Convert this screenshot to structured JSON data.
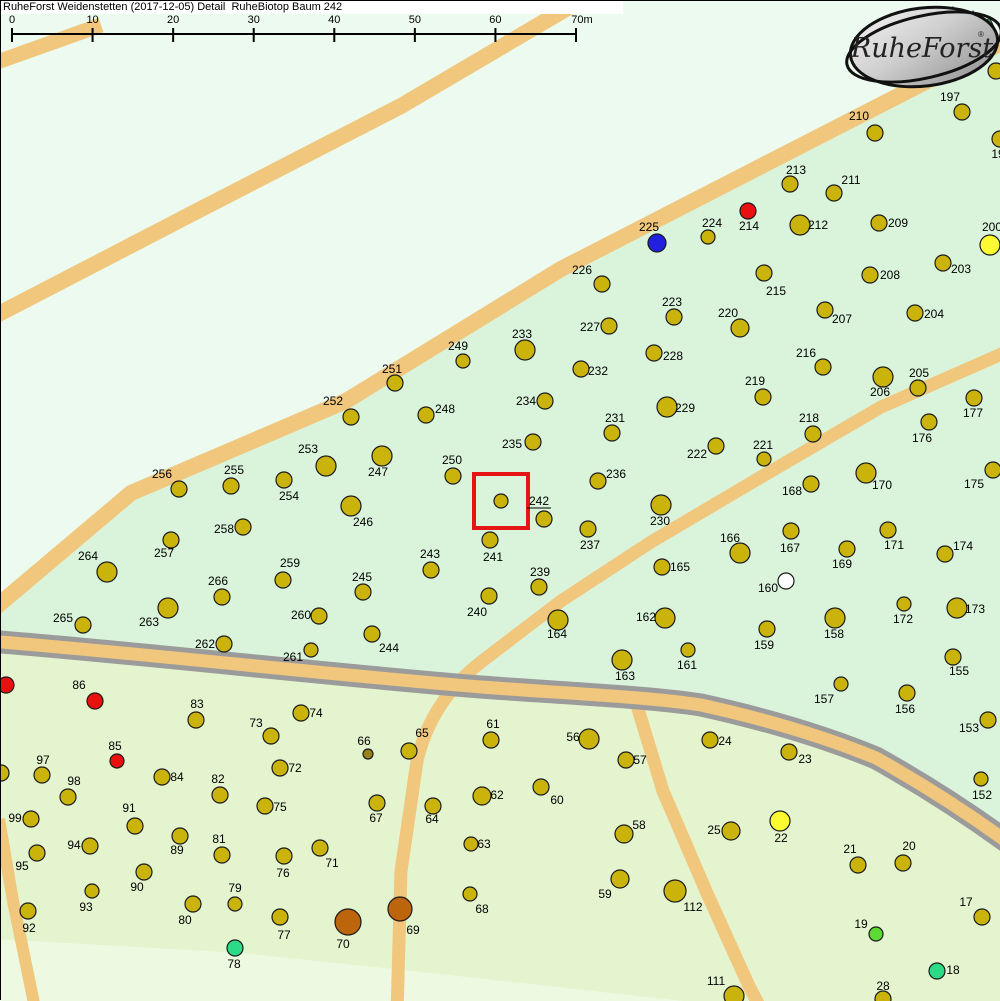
{
  "header": {
    "title": "RuheForst Weidenstetten (2017-12-05) Detail  RuheBiotop Baum 242"
  },
  "scalebar": {
    "labels": [
      "0",
      "10",
      "20",
      "30",
      "40",
      "50",
      "60",
      "70m"
    ],
    "x_start": 11,
    "x_end": 575,
    "baseline_y": 33
  },
  "logo": {
    "text": "RuheForst",
    "registered_mark": "®"
  },
  "selection": {
    "number": "242",
    "box": [
      473,
      473,
      54,
      54
    ],
    "box_color": "#e61414"
  },
  "colors": {
    "d": "#cab40c",
    "o": "#bd650c",
    "r": "#ea1010",
    "b": "#2020dd",
    "w": "#ffffff",
    "y": "#fcfa30",
    "g": "#2bdb85",
    "gy": "#5cd932",
    "dk": "#97831c",
    "dot_stroke": "#1a1a1a",
    "area_pale": "#ecfaef",
    "area_mint": "#daf4dc",
    "area_bottom": "#e4f4cf",
    "area_bottom_pale": "#eef9e2",
    "path_tan": "#f0c77c",
    "road_gray": "#9b9b9b",
    "logo_tree_green": "#2d9e4f"
  },
  "chart_data": {
    "type": "scatter",
    "title": "RuheForst Weidenstetten tree map detail around RuheBiotop Baum 242",
    "note": "trees format: [number, dotX, dotY, labelX, labelY, colorKey, radius]; empty number = dot with no visible label"
  },
  "trees": [
    [
      "197",
      961,
      111,
      949,
      96
    ],
    [
      "19",
      999,
      138,
      997,
      153
    ],
    [
      "",
      995,
      70
    ],
    [
      "210",
      874,
      132,
      858,
      115
    ],
    [
      "213",
      789,
      183,
      795,
      169
    ],
    [
      "211",
      833,
      192,
      850,
      179
    ],
    [
      "214",
      747,
      210,
      748,
      225,
      "r",
      8
    ],
    [
      "224",
      707,
      236,
      711,
      222,
      "d",
      7
    ],
    [
      "225",
      656,
      242,
      648,
      226,
      "b",
      9
    ],
    [
      "212",
      799,
      224,
      817,
      224,
      "d",
      10
    ],
    [
      "209",
      878,
      222,
      897,
      222
    ],
    [
      "200",
      989,
      244,
      991,
      226,
      "y",
      10
    ],
    [
      "226",
      601,
      283,
      581,
      269
    ],
    [
      "208",
      869,
      274,
      889,
      274
    ],
    [
      "203",
      942,
      262,
      960,
      268
    ],
    [
      "215",
      763,
      272,
      775,
      290
    ],
    [
      "223",
      673,
      316,
      671,
      301
    ],
    [
      "220",
      739,
      327,
      727,
      312,
      "d",
      9
    ],
    [
      "207",
      824,
      309,
      841,
      318
    ],
    [
      "204",
      914,
      312,
      933,
      313
    ],
    [
      "227",
      608,
      325,
      589,
      326
    ],
    [
      "216",
      822,
      366,
      805,
      352
    ],
    [
      "228",
      653,
      352,
      672,
      355
    ],
    [
      "232",
      580,
      368,
      597,
      370
    ],
    [
      "206",
      882,
      376,
      879,
      391,
      "d",
      10
    ],
    [
      "205",
      917,
      387,
      918,
      372
    ],
    [
      "177",
      973,
      397,
      972,
      412
    ],
    [
      "219",
      762,
      396,
      754,
      380
    ],
    [
      "229",
      666,
      406,
      684,
      407,
      "d",
      10
    ],
    [
      "231",
      611,
      432,
      614,
      417
    ],
    [
      "218",
      812,
      433,
      808,
      417
    ],
    [
      "176",
      928,
      421,
      921,
      437
    ],
    [
      "222",
      715,
      445,
      696,
      453
    ],
    [
      "221",
      763,
      458,
      762,
      444,
      "d",
      7
    ],
    [
      "236",
      597,
      480,
      615,
      473
    ],
    [
      "170",
      865,
      472,
      881,
      484,
      "d",
      10
    ],
    [
      "168",
      810,
      483,
      791,
      490
    ],
    [
      "175",
      992,
      469,
      973,
      483
    ],
    [
      "249",
      462,
      360,
      457,
      345,
      "d",
      7
    ],
    [
      "233",
      524,
      349,
      521,
      333,
      "d",
      10
    ],
    [
      "251",
      394,
      382,
      391,
      368
    ],
    [
      "252",
      350,
      416,
      332,
      400
    ],
    [
      "248",
      425,
      414,
      444,
      408
    ],
    [
      "234",
      544,
      400,
      525,
      400
    ],
    [
      "235",
      532,
      441,
      511,
      443
    ],
    [
      "253",
      325,
      465,
      307,
      448,
      "d",
      10
    ],
    [
      "247",
      381,
      455,
      377,
      471,
      "d",
      10
    ],
    [
      "250",
      452,
      475,
      451,
      459
    ],
    [
      "242",
      500,
      500,
      538,
      500,
      "d",
      7
    ],
    [
      "",
      543,
      518
    ],
    [
      "254",
      283,
      479,
      288,
      495
    ],
    [
      "255",
      230,
      485,
      233,
      469
    ],
    [
      "256",
      178,
      488,
      161,
      473
    ],
    [
      "246",
      350,
      505,
      362,
      521,
      "d",
      10
    ],
    [
      "258",
      242,
      526,
      223,
      528
    ],
    [
      "257",
      170,
      539,
      163,
      552
    ],
    [
      "264",
      106,
      571,
      87,
      555,
      "d",
      10
    ],
    [
      "243",
      430,
      569,
      429,
      553
    ],
    [
      "241",
      489,
      539,
      492,
      556
    ],
    [
      "237",
      587,
      528,
      589,
      544
    ],
    [
      "230",
      660,
      504,
      659,
      520,
      "d",
      10
    ],
    [
      "239",
      538,
      586,
      539,
      571
    ],
    [
      "240",
      488,
      595,
      476,
      611
    ],
    [
      "164",
      557,
      619,
      556,
      633,
      "d",
      10
    ],
    [
      "165",
      661,
      566,
      679,
      566
    ],
    [
      "162",
      664,
      617,
      645,
      616,
      "d",
      10
    ],
    [
      "163",
      621,
      659,
      624,
      675,
      "d",
      10
    ],
    [
      "161",
      687,
      649,
      686,
      664,
      "d",
      7
    ],
    [
      "160",
      785,
      580,
      767,
      587,
      "w",
      8
    ],
    [
      "159",
      766,
      628,
      763,
      644
    ],
    [
      "166",
      739,
      552,
      729,
      537,
      "d",
      10
    ],
    [
      "167",
      790,
      530,
      789,
      547
    ],
    [
      "171",
      887,
      529,
      893,
      544
    ],
    [
      "174",
      944,
      553,
      962,
      545
    ],
    [
      "169",
      846,
      548,
      841,
      563
    ],
    [
      "172",
      903,
      603,
      902,
      618,
      "d",
      7
    ],
    [
      "173",
      956,
      607,
      974,
      608,
      "d",
      10
    ],
    [
      "158",
      834,
      617,
      833,
      633,
      "d",
      10
    ],
    [
      "155",
      952,
      656,
      958,
      670
    ],
    [
      "157",
      840,
      683,
      823,
      698,
      "d",
      7
    ],
    [
      "156",
      906,
      692,
      904,
      708
    ],
    [
      "153",
      987,
      719,
      968,
      727
    ],
    [
      "152",
      980,
      778,
      981,
      794,
      "d",
      7
    ],
    [
      "265",
      82,
      624,
      62,
      617
    ],
    [
      "263",
      167,
      607,
      148,
      621,
      "d",
      10
    ],
    [
      "266",
      221,
      596,
      217,
      580
    ],
    [
      "259",
      282,
      579,
      289,
      562
    ],
    [
      "260",
      318,
      615,
      300,
      614
    ],
    [
      "262",
      223,
      643,
      204,
      643
    ],
    [
      "261",
      310,
      649,
      292,
      656,
      "d",
      7
    ],
    [
      "245",
      362,
      591,
      361,
      576
    ],
    [
      "244",
      371,
      633,
      388,
      647
    ],
    [
      "86",
      94,
      700,
      78,
      684,
      "r",
      8
    ],
    [
      "",
      5,
      684,
      0,
      0,
      "r",
      8
    ],
    [
      "",
      0,
      772,
      0,
      0,
      "d",
      8
    ],
    [
      "83",
      195,
      719,
      196,
      703
    ],
    [
      "74",
      300,
      712,
      315,
      712
    ],
    [
      "73",
      270,
      735,
      255,
      722
    ],
    [
      "85",
      116,
      760,
      114,
      745,
      "r",
      7
    ],
    [
      "97",
      41,
      774,
      42,
      759
    ],
    [
      "98",
      67,
      796,
      73,
      780
    ],
    [
      "84",
      161,
      776,
      176,
      776
    ],
    [
      "82",
      219,
      794,
      217,
      778
    ],
    [
      "72",
      279,
      767,
      294,
      767
    ],
    [
      "75",
      264,
      805,
      279,
      806
    ],
    [
      "91",
      134,
      825,
      128,
      807
    ],
    [
      "99",
      30,
      818,
      14,
      817
    ],
    [
      "94",
      89,
      845,
      73,
      844
    ],
    [
      "89",
      179,
      835,
      176,
      849
    ],
    [
      "81",
      221,
      854,
      218,
      838
    ],
    [
      "95",
      36,
      852,
      21,
      865
    ],
    [
      "76",
      283,
      855,
      282,
      872
    ],
    [
      "71",
      319,
      847,
      331,
      862
    ],
    [
      "90",
      143,
      871,
      136,
      886
    ],
    [
      "93",
      91,
      890,
      85,
      906,
      "d",
      7
    ],
    [
      "79",
      234,
      903,
      234,
      887,
      "d",
      7
    ],
    [
      "80",
      192,
      903,
      184,
      919
    ],
    [
      "77",
      279,
      916,
      283,
      934
    ],
    [
      "92",
      27,
      910,
      28,
      927
    ],
    [
      "70",
      347,
      921,
      342,
      943,
      "o",
      13
    ],
    [
      "78",
      234,
      947,
      233,
      963,
      "g",
      8
    ],
    [
      "69",
      399,
      908,
      412,
      929,
      "o",
      12
    ],
    [
      "66",
      367,
      753,
      363,
      740,
      "dk",
      5
    ],
    [
      "65",
      408,
      750,
      421,
      732
    ],
    [
      "61",
      490,
      739,
      492,
      723
    ],
    [
      "56",
      588,
      738,
      572,
      736,
      "d",
      10
    ],
    [
      "57",
      625,
      759,
      639,
      759
    ],
    [
      "62",
      481,
      795,
      496,
      794,
      "d",
      9
    ],
    [
      "60",
      540,
      786,
      556,
      799
    ],
    [
      "67",
      376,
      802,
      375,
      817
    ],
    [
      "64",
      432,
      805,
      431,
      818
    ],
    [
      "58",
      623,
      833,
      638,
      824,
      "d",
      9
    ],
    [
      "63",
      470,
      843,
      483,
      843,
      "d",
      7
    ],
    [
      "59",
      619,
      878,
      604,
      893,
      "d",
      9
    ],
    [
      "68",
      469,
      893,
      481,
      908,
      "d",
      7
    ],
    [
      "112",
      674,
      890,
      692,
      906,
      "d",
      11
    ],
    [
      "24",
      709,
      739,
      724,
      740
    ],
    [
      "23",
      788,
      751,
      804,
      758
    ],
    [
      "25",
      730,
      830,
      713,
      829,
      "d",
      9
    ],
    [
      "22",
      779,
      820,
      780,
      837,
      "y",
      10
    ],
    [
      "21",
      857,
      864,
      849,
      848
    ],
    [
      "20",
      902,
      862,
      908,
      845
    ],
    [
      "17",
      981,
      916,
      965,
      901
    ],
    [
      "19",
      875,
      933,
      860,
      923,
      "gy",
      7
    ],
    [
      "18",
      936,
      970,
      952,
      969,
      "g",
      8
    ],
    [
      "28",
      882,
      998,
      882,
      985
    ],
    [
      "111",
      733,
      995,
      715,
      980,
      "d",
      10
    ]
  ]
}
